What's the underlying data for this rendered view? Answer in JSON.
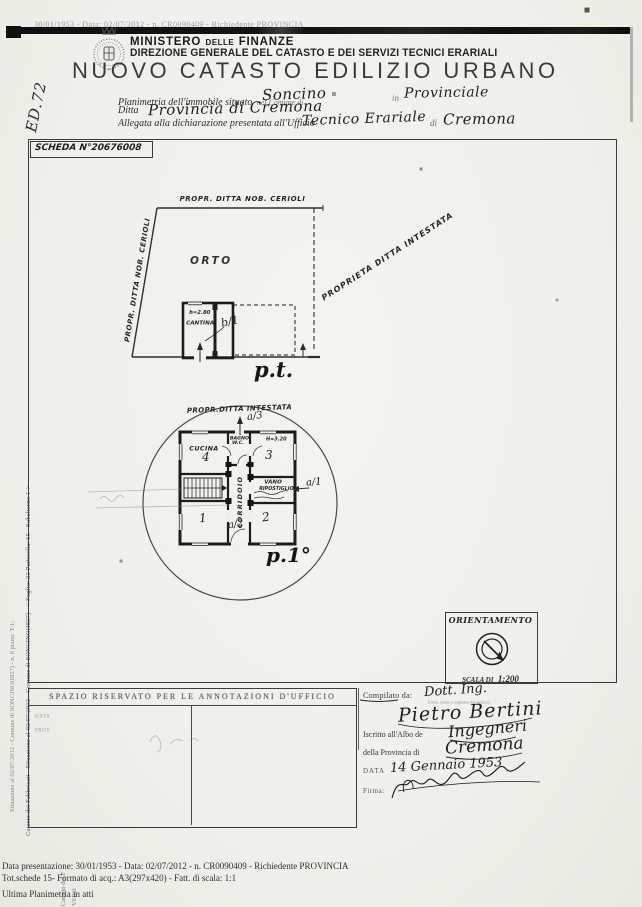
{
  "colors": {
    "paper": "#f1f0eb",
    "ink": "#2a2a2a",
    "line": "#3c3c3c",
    "ghost": "#8a8a8a"
  },
  "icons": {
    "emblem": "ministry-crest-icon",
    "compass": "compass-icon",
    "arrows": "entrance-arrow-icon",
    "signature": "signature-scribble"
  },
  "scan": {
    "ghost_strip_text": "30/01/1953 - Data: 02/07/2012 - n. CR0090409 - Richiedente PROVINCIA",
    "margin_note": "ED.72"
  },
  "header": {
    "ministry_a": "MINISTERO",
    "ministry_b": "DELLE",
    "ministry_c": "FINANZE",
    "direction_line": "DIREZIONE GENERALE DEL CATASTO E DEI SERVIZI TECNICI ERARIALI",
    "title": "NUOVO CATASTO EDILIZIO URBANO"
  },
  "form": {
    "line1_label_a": "Planimetria dell'immobile situato",
    "line1_label_b": "nel Comune di",
    "line1_value_comune": "Soncino",
    "line1_label_c": "in",
    "line1_value_provincia": "Provinciale",
    "line2_label": "Ditta",
    "line2_value": "Provincia di Cremona",
    "line3_label_a": "Allegata alla dichiarazione presentata all'Ufficio",
    "line3_value_ufficio": "Tecnico Erariale",
    "line3_label_b": "di",
    "line3_value_citta": "Cremona"
  },
  "sheet": {
    "scheda_label": "SCHEDA N°20676008"
  },
  "ground_floor": {
    "boundary_top": "PROPR. DITTA NOB. CERIOLI",
    "boundary_left": "PROPR. DITTA NOB. CERIOLI",
    "boundary_diag": "PROPRIETA DITTA INTESTATA",
    "garden": "ORTO",
    "height_note": "h=2.80",
    "room_cantina": "CANTINA",
    "annotation_b1": "b/1",
    "floor_label": "p.t."
  },
  "first_floor": {
    "boundary_top": "PROPR.DITTA INTESTATA",
    "annotation_a3": "a/3",
    "annotation_a1": "a/1",
    "annotation_a2": "a/2",
    "room_cucina": "CUCINA",
    "num_4": "4",
    "room_bagno_1": "BAGNO",
    "room_bagno_2": "W.C.",
    "num_3": "3",
    "height_note": "H=3.20",
    "vano_1": "VANO",
    "vano_2": "RIPOSTIGLIO",
    "corridor": "CORRIDOIO",
    "num_1": "1",
    "num_2": "2",
    "floor_label": "p.1°"
  },
  "orientation": {
    "title": "ORIENTAMENTO",
    "scale_label": "SCALA DI",
    "scale_value": "1:200"
  },
  "annotations_box": {
    "header": "SPAZIO RISERVATO PER LE ANNOTAZIONI D'UFFICIO",
    "label_data": "DATA",
    "label_prot": "PROT."
  },
  "compiler": {
    "label_compilato": "Compilato da:",
    "value_title": "Dott. Ing.",
    "sub_note": "(titolo, nome e cognome del tecnico)",
    "value_name": "Pietro Bertini",
    "label_albo": "Iscritto all'Albo de",
    "value_albo": "Ingegneri",
    "label_provincia": "della Provincia di",
    "value_provincia": "Cremona",
    "label_data": "DATA",
    "value_data": "14 Gennaio 1953",
    "label_firma": "Firma:"
  },
  "footer": {
    "line1": "Data presentazione: 30/01/1953 - Data: 02/07/2012 -  n. CR0090409 - Richiedente PROVINCIA",
    "line2": "Tot.schede 15- Formato di acq.: A3(297x420) - Fatt. di scala: 1:1",
    "line3": "Ultima Planimetria in atti"
  },
  "left_margin": {
    "line_a": "Catasto dei Fabbricati - Situazione al 02/07/2012 - Comune di SONCINO(I827) - < Foglio: 22 Particella: 65 - Subalterno 1 >",
    "line_b": "Situazione al 02/07/2012 - Comune di SONCINO(I827) - n. 8 piano: T-1;",
    "frag_1": "Catasto dei F",
    "frag_2": "VERO"
  }
}
